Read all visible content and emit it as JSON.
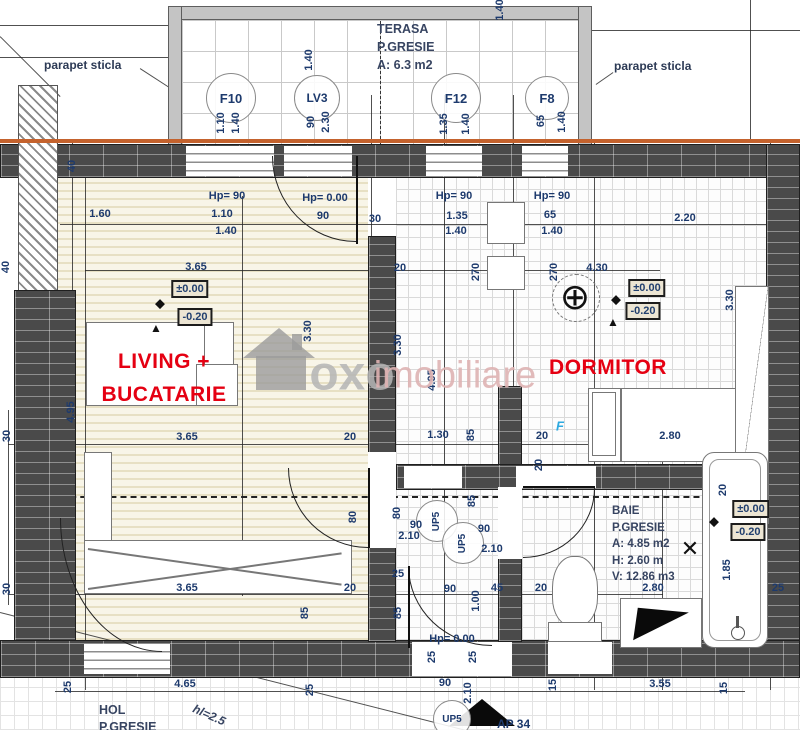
{
  "apartment": {
    "label": "AP 34"
  },
  "rooms": {
    "living": {
      "line1": "LIVING +",
      "line2": "BUCATARIE"
    },
    "dormitor": {
      "label": "DORMITOR"
    },
    "terasa": {
      "line1": "TERASA",
      "line2": "P.GRESIE",
      "line3": "A: 6.3 m2"
    },
    "baie": {
      "line1": "BAIE",
      "line2": "P.GRESIE",
      "line3": "A: 4.85 m2",
      "line4": "H: 2.60 m",
      "line5": "V: 12.86 m3"
    },
    "hol": {
      "line1": "HOL",
      "line2": "P.GRESIE",
      "note": "hl=2.5"
    }
  },
  "annotations": {
    "parapet_left": "parapet sticla",
    "parapet_right": "parapet sticla"
  },
  "watermark": {
    "bold": "oxo",
    "light": "imobiliare"
  },
  "colors": {
    "accent_red": "#e50012",
    "dim_blue": "#1d3a6d",
    "wall_gray": "#4a4a4a",
    "parapet_orange": "#c4622d",
    "watermark_pink": "#dfb3b3"
  },
  "tags": [
    {
      "id": "F10",
      "x": 231,
      "y": 98,
      "d": 50,
      "fs": 13
    },
    {
      "id": "LV3",
      "x": 317,
      "y": 98,
      "d": 46,
      "fs": 12
    },
    {
      "id": "F12",
      "x": 456,
      "y": 98,
      "d": 50,
      "fs": 13
    },
    {
      "id": "F8",
      "x": 547,
      "y": 98,
      "d": 44,
      "fs": 13
    },
    {
      "id": "UP5",
      "x": 452,
      "y": 719,
      "d": 38,
      "fs": 10
    },
    {
      "id": "UP5",
      "x": 437,
      "y": 521,
      "d": 42,
      "fs": 10,
      "rot": -90
    },
    {
      "id": "UP5",
      "x": 463,
      "y": 543,
      "d": 42,
      "fs": 10,
      "rot": -90
    }
  ],
  "hp_labels": [
    {
      "t": "Hp= 90",
      "x": 227,
      "y": 196
    },
    {
      "t": "Hp= 0.00",
      "x": 325,
      "y": 198
    },
    {
      "t": "Hp= 90",
      "x": 454,
      "y": 196
    },
    {
      "t": "Hp= 90",
      "x": 552,
      "y": 196
    },
    {
      "t": "Hp= 0.00",
      "x": 452,
      "y": 639
    }
  ],
  "levels": [
    {
      "t": "±0.00",
      "x": 190,
      "y": 289
    },
    {
      "t": "-0.20",
      "x": 195,
      "y": 317
    },
    {
      "t": "±0.00",
      "x": 647,
      "y": 288
    },
    {
      "t": "-0.20",
      "x": 643,
      "y": 311
    },
    {
      "t": "±0.00",
      "x": 751,
      "y": 509
    },
    {
      "t": "-0.20",
      "x": 748,
      "y": 532
    }
  ],
  "marks": [
    {
      "g": "◆",
      "x": 160,
      "y": 303,
      "s": 13
    },
    {
      "g": "▲",
      "x": 156,
      "y": 328,
      "s": 12
    },
    {
      "g": "◆",
      "x": 616,
      "y": 299,
      "s": 13
    },
    {
      "g": "▲",
      "x": 613,
      "y": 322,
      "s": 12
    },
    {
      "g": "◆",
      "x": 714,
      "y": 521,
      "s": 13
    },
    {
      "g": "✕",
      "x": 690,
      "y": 549,
      "s": 22
    },
    {
      "g": "⊕",
      "x": 575,
      "y": 297,
      "s": 36
    }
  ],
  "dims": [
    {
      "t": "1.40",
      "x": 309,
      "y": 60,
      "r": -90
    },
    {
      "t": "1.40",
      "x": 500,
      "y": 10,
      "r": -90
    },
    {
      "t": "1.10",
      "x": 221,
      "y": 123,
      "r": -90
    },
    {
      "t": "1.40",
      "x": 236,
      "y": 123,
      "r": -90
    },
    {
      "t": "90",
      "x": 311,
      "y": 122,
      "r": -90
    },
    {
      "t": "2.30",
      "x": 326,
      "y": 122,
      "r": -90
    },
    {
      "t": "1.35",
      "x": 444,
      "y": 124,
      "r": -90
    },
    {
      "t": "1.40",
      "x": 466,
      "y": 124,
      "r": -90
    },
    {
      "t": "65",
      "x": 541,
      "y": 121,
      "r": -90
    },
    {
      "t": "1.40",
      "x": 562,
      "y": 122,
      "r": -90
    },
    {
      "t": "1.60",
      "x": 100,
      "y": 214
    },
    {
      "t": "1.10",
      "x": 222,
      "y": 214
    },
    {
      "t": "1.40",
      "x": 226,
      "y": 231
    },
    {
      "t": "90",
      "x": 323,
      "y": 216
    },
    {
      "t": "30",
      "x": 375,
      "y": 219
    },
    {
      "t": "1.35",
      "x": 457,
      "y": 216
    },
    {
      "t": "1.40",
      "x": 456,
      "y": 231
    },
    {
      "t": "65",
      "x": 550,
      "y": 215
    },
    {
      "t": "1.40",
      "x": 552,
      "y": 231
    },
    {
      "t": "2.20",
      "x": 685,
      "y": 218
    },
    {
      "t": "3.65",
      "x": 196,
      "y": 267
    },
    {
      "t": "20",
      "x": 400,
      "y": 268
    },
    {
      "t": "270",
      "x": 476,
      "y": 272,
      "r": -90
    },
    {
      "t": "270",
      "x": 554,
      "y": 272,
      "r": -90
    },
    {
      "t": "4.30",
      "x": 597,
      "y": 268
    },
    {
      "t": "3.30",
      "x": 308,
      "y": 331,
      "r": -90
    },
    {
      "t": "3.30",
      "x": 398,
      "y": 345,
      "r": -90
    },
    {
      "t": "3.30",
      "x": 730,
      "y": 300,
      "r": -90
    },
    {
      "t": "4.95",
      "x": 71,
      "y": 412,
      "r": -90
    },
    {
      "t": "4.95",
      "x": 432,
      "y": 380,
      "r": -90
    },
    {
      "t": "40",
      "x": 72,
      "y": 166,
      "r": -90
    },
    {
      "t": "40",
      "x": 6,
      "y": 267,
      "r": -90
    },
    {
      "t": "30",
      "x": 7,
      "y": 436,
      "r": -90
    },
    {
      "t": "30",
      "x": 7,
      "y": 589,
      "r": -90
    },
    {
      "t": "3.65",
      "x": 187,
      "y": 437
    },
    {
      "t": "20",
      "x": 350,
      "y": 437
    },
    {
      "t": "1.30",
      "x": 438,
      "y": 435
    },
    {
      "t": "85",
      "x": 471,
      "y": 435,
      "r": -90
    },
    {
      "t": "20",
      "x": 542,
      "y": 436
    },
    {
      "t": "F",
      "x": 560,
      "y": 426,
      "cls": "f"
    },
    {
      "t": "2.80",
      "x": 670,
      "y": 436
    },
    {
      "t": "20",
      "x": 539,
      "y": 465,
      "r": -90
    },
    {
      "t": "80",
      "x": 353,
      "y": 517,
      "r": -90
    },
    {
      "t": "80",
      "x": 397,
      "y": 513,
      "r": -90
    },
    {
      "t": "90",
      "x": 416,
      "y": 525
    },
    {
      "t": "2.10",
      "x": 409,
      "y": 536
    },
    {
      "t": "85",
      "x": 472,
      "y": 501,
      "r": -90
    },
    {
      "t": "90",
      "x": 484,
      "y": 529
    },
    {
      "t": "2.10",
      "x": 492,
      "y": 549
    },
    {
      "t": "25",
      "x": 398,
      "y": 574
    },
    {
      "t": "90",
      "x": 450,
      "y": 589
    },
    {
      "t": "45",
      "x": 497,
      "y": 588
    },
    {
      "t": "20",
      "x": 541,
      "y": 588
    },
    {
      "t": "1.00",
      "x": 476,
      "y": 601,
      "r": -90
    },
    {
      "t": "85",
      "x": 398,
      "y": 613,
      "r": -90
    },
    {
      "t": "25",
      "x": 432,
      "y": 657,
      "r": -90
    },
    {
      "t": "25",
      "x": 473,
      "y": 657,
      "r": -90
    },
    {
      "t": "3.65",
      "x": 187,
      "y": 588
    },
    {
      "t": "20",
      "x": 350,
      "y": 588
    },
    {
      "t": "85",
      "x": 305,
      "y": 613,
      "r": -90
    },
    {
      "t": "2.80",
      "x": 653,
      "y": 588
    },
    {
      "t": "1.85",
      "x": 727,
      "y": 570,
      "r": -90
    },
    {
      "t": "25",
      "x": 778,
      "y": 588
    },
    {
      "t": "20",
      "x": 723,
      "y": 490,
      "r": -90
    },
    {
      "t": "25",
      "x": 68,
      "y": 687,
      "r": -90
    },
    {
      "t": "4.65",
      "x": 185,
      "y": 684
    },
    {
      "t": "25",
      "x": 310,
      "y": 690,
      "r": -90
    },
    {
      "t": "90",
      "x": 445,
      "y": 683
    },
    {
      "t": "2.10",
      "x": 468,
      "y": 693,
      "r": -90
    },
    {
      "t": "15",
      "x": 553,
      "y": 685,
      "r": -90
    },
    {
      "t": "3.55",
      "x": 660,
      "y": 684
    },
    {
      "t": "15",
      "x": 724,
      "y": 688,
      "r": -90
    }
  ]
}
